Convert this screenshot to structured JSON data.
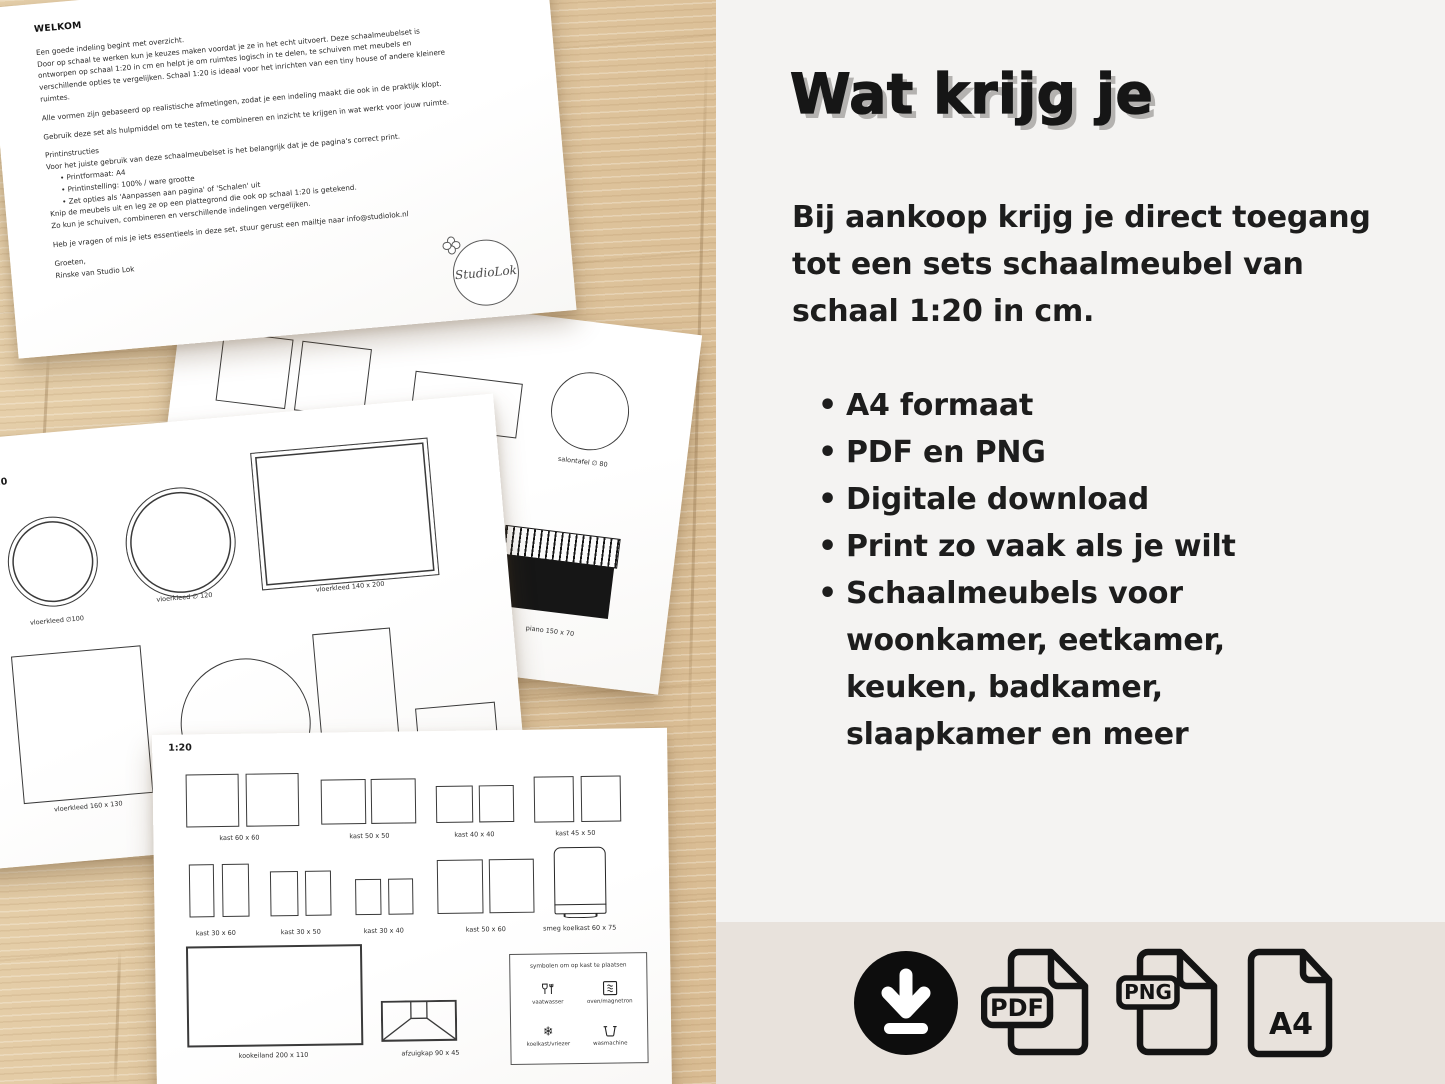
{
  "letter": {
    "heading": "WELKOM",
    "lines": [
      "Een goede indeling begint met overzicht.",
      "Door op schaal te werken kun je keuzes maken voordat je ze in het echt uitvoert. Deze schaalmeubelset is",
      "ontworpen op schaal 1:20 in cm en helpt je om ruimtes logisch in te delen, te schuiven met meubels en",
      "verschillende opties te vergelijken. Schaal 1:20 is ideaal voor het inrichten van een tiny house of andere kleinere",
      "ruimtes.",
      "",
      "Alle vormen zijn gebaseerd op realistische afmetingen, zodat je een indeling maakt die ook in de praktijk klopt.",
      "",
      "Gebruik deze set als hulpmiddel om te testen, te combineren en inzicht te krijgen in wat werkt voor jouw ruimte.",
      "",
      "Printinstructies",
      "Voor het juiste gebruik van deze schaalmeubelset is het belangrijk dat je de pagina's correct print.",
      "•  Printformaat: A4",
      "•  Printinstelling: 100% / ware grootte",
      "•  Zet opties als 'Aanpassen aan pagina' of 'Schalen' uit",
      "Knip de meubels uit en leg ze op een plattegrond die ook op schaal 1:20 is getekend.",
      "Zo kun je schuiven, combineren en verschillende indelingen vergelijken.",
      "",
      "Heb je vragen of mis je iets essentieels in deze set, stuur gerust een mailtje naar info@studiolok.nl",
      "",
      "Groeten,",
      "Rinske van Studio Lok"
    ],
    "logo_text": "StudioLok"
  },
  "paper_salontafels": {
    "scale": "1:20",
    "label_squares": "salontafel 80 x 80",
    "label_circle": "salontafel ∅ 80",
    "label_piano": "piano 150 x 70"
  },
  "paper_vloerkleden": {
    "scale": "1:20",
    "label_c100": "vloerkleed ∅100",
    "label_c120": "vloerkleed ∅ 120",
    "label_r140": "vloerkleed 140 x 200",
    "label_r160": "vloerkleed 160 x 130"
  },
  "paper_kasten": {
    "scale": "1:20",
    "row1": [
      {
        "label": "kast 60 x 60"
      },
      {
        "label": "kast 50 x 50"
      },
      {
        "label": "kast 40 x 40"
      },
      {
        "label": "kast 45 x 50"
      }
    ],
    "row2": [
      {
        "label": "kast 30 x 60"
      },
      {
        "label": "kast 30 x 50"
      },
      {
        "label": "kast 30 x 40"
      },
      {
        "label": "kast 50 x 60"
      },
      {
        "label": "smeg koelkast 60 x 75"
      }
    ],
    "label_kookeiland": "kookeiland 200 x 110",
    "label_afzuigkap": "afzuigkap 90 x 45",
    "symbols": {
      "title": "symbolen om op kast te plaatsen",
      "items": [
        {
          "label": "vaatwasser"
        },
        {
          "label": "oven/magnetron"
        },
        {
          "label": "koelkast/vriezer"
        },
        {
          "label": "wasmachine"
        }
      ]
    }
  },
  "panel": {
    "title": "Wat krijg je",
    "intro_lines": [
      "Bij aankoop krijg je direct toegang",
      "tot een sets schaalmeubel van",
      "schaal 1:20 in cm."
    ],
    "bullets": [
      {
        "lines": [
          "A4 formaat"
        ]
      },
      {
        "lines": [
          "PDF en PNG"
        ]
      },
      {
        "lines": [
          "Digitale download"
        ]
      },
      {
        "lines": [
          "Print zo vaak als je wilt"
        ]
      },
      {
        "lines": [
          "Schaalmeubels voor",
          "woonkamer, eetkamer,",
          "keuken, badkamer,",
          "slaapkamer en meer"
        ]
      }
    ],
    "icons": {
      "pdf_label": "PDF",
      "png_label": "PNG",
      "a4_label": "A4"
    },
    "colors": {
      "bg_top": "#f4f3f2",
      "bg_bottom": "#e8e2dc",
      "text": "#1d1d1d",
      "title_shadow": "#b4b2b0"
    }
  }
}
